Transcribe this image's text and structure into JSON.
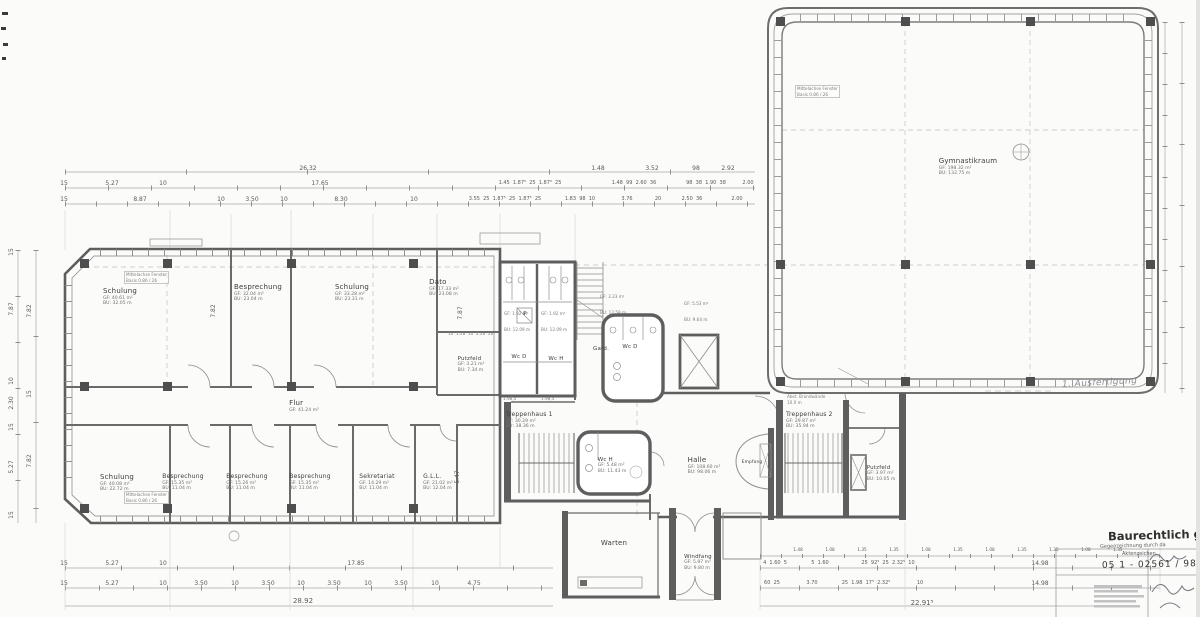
{
  "plan": {
    "rooms": {
      "schulung_tl": {
        "name": "Schulung",
        "gf": "GF: 40.61 m²",
        "bu": "BU: 32.05 m"
      },
      "besprechung_t": {
        "name": "Besprechung",
        "gf": "GF: 32.04 m²",
        "bu": "BU: 23.04 m"
      },
      "schulung_tm": {
        "name": "Schulung",
        "gf": "GF: 33.28 m²",
        "bu": "BU: 23.31 m"
      },
      "dato": {
        "name": "Dato",
        "gf": "GF: 17.33 m²",
        "bu": "BU: 23.08 m"
      },
      "flur": {
        "name": "Flur",
        "gf": "GF: 41.24 m²",
        "bu": "BU: 47.34 m"
      },
      "putzfeld_l": {
        "name": "Putzfeld",
        "gf": "GF: 3.21 m²",
        "bu": "BU: 7.34 m"
      },
      "wc_d_top": {
        "name": "Wc D",
        "gf": "GF: 1.92 m²",
        "bu": "BU: 12.09 m"
      },
      "wc_h_top": {
        "name": "Wc H",
        "gf": "GF: 1.92 m²",
        "bu": "BU: 12.09 m"
      },
      "p_shaft": {
        "name": "P"
      },
      "gard": {
        "name": "Gard."
      },
      "wc_d_mid": {
        "name": "Wc D",
        "gf": "GF: 3.23 m²",
        "bu": "BU: 12.58 m"
      },
      "aufzug": {
        "gf": "GF: 5.53 m²",
        "bu": "BU: 9.64 m"
      },
      "treppenhaus_1": {
        "name": "Treppenhaus 1",
        "gf": "GF: 30.29 m²",
        "bu": "BU: 38.36 m"
      },
      "wc_h_low": {
        "name": "Wc H",
        "gf": "GF: 5.48 m²",
        "bu": "BU: 11.43 m"
      },
      "halle": {
        "name": "Halle",
        "gf": "GF: 108.60 m²",
        "bu": "BU: 98.06 m"
      },
      "empfang": {
        "name": "Empfang"
      },
      "treppenhaus_2": {
        "name": "Treppenhaus 2",
        "gf": "GF: 29.87 m²",
        "bu": "BU: 35.94 m"
      },
      "putzfeld_r": {
        "name": "Putzfeld",
        "gf": "GF: 3.97 m²",
        "bu": "BU: 10.05 m"
      },
      "warten": {
        "name": "Warten"
      },
      "windfang": {
        "name": "Windfang",
        "gf": "GF: 5.97 m²",
        "bu": "BU: 9.80 m"
      },
      "gymnastikraum": {
        "name": "Gymnastikraum",
        "gf": "GF: 198.32 m²",
        "bu": "BU: 132.75 m"
      },
      "schulung_b": {
        "name": "Schulung",
        "gf": "GF: 40.08 m²",
        "bu": "BU: 22.72 m"
      },
      "besprechung_b1": {
        "name": "Besprechung",
        "gf": "GF: 15.35 m²",
        "bu": "BU: 11.04 m"
      },
      "besprechung_b2": {
        "name": "Besprechung",
        "gf": "GF: 15.26 m²",
        "bu": "BU: 11.04 m"
      },
      "besprechung_b3": {
        "name": "Besprechung",
        "gf": "GF: 15.35 m²",
        "bu": "BU: 11.04 m"
      },
      "sekretariat": {
        "name": "Sekretariat",
        "gf": "GF: 14.29 m²",
        "bu": "BU: 11.04 m"
      },
      "gll": {
        "name": "G.L.L.",
        "gf": "GF: 21.02 m²",
        "bu": "BU: 12.04 m"
      }
    },
    "notes": {
      "fenster_tl": {
        "l1": "Mittelachse Fenster",
        "l2": "Basis 0.86 /.26"
      },
      "fenster_bl": {
        "l1": "Mittelachse Fenster",
        "l2": "Basis 0.86 /.26"
      },
      "fenster_gym": {
        "l1": "Mittelachse Fenster",
        "l2": "Basis 0.86 /.26"
      },
      "brandwand": {
        "l1": "Abst. Brandwände",
        "l2": "10.0 m"
      },
      "wc_micro": "1.98,5",
      "dato_micro": "10  1.28  10  2.26  26"
    },
    "stamp": {
      "ausfertigung": "1. Ausfertigung",
      "baurecht": "Baurechtlich ge",
      "gegenzeichnung": "Gegenzeichnung durch da",
      "aktenzeichen": "Aktenzeichen",
      "nummer": "05 1 - 02561 / 98"
    },
    "dims": {
      "ra": [
        "26.32",
        "1.48",
        "3.52",
        "98",
        "2.92"
      ],
      "rb": [
        "15",
        "5.27",
        "10",
        "17.65",
        "1.45  1.87⁵  25  1.87⁵  25",
        "1.48  99  2.60  36",
        "98  38  1.90  38",
        "2.00"
      ],
      "rc": [
        "15",
        "8.87",
        "10",
        "3.50",
        "10",
        "8.30",
        "10",
        "3.55  25  1.87⁵  25  1.87⁵  25",
        "1.83  98  10",
        "3.76",
        "20",
        "2.50  36",
        "2.00"
      ],
      "rd": [
        "15",
        "5.27",
        "10",
        "17.85"
      ],
      "rdr": [
        "4  1.60  5",
        "5  1.60",
        "25  92⁵  25  2.32⁵  10",
        "14.98"
      ],
      "re": [
        "15",
        "5.27",
        "10",
        "3.50",
        "10",
        "3.50",
        "10",
        "3.50",
        "10",
        "3.50",
        "10",
        "4.75"
      ],
      "rer": [
        "60  25",
        "3.70",
        "25  1.98  17⁵  2.32⁵",
        "10",
        "14.98"
      ],
      "rf": [
        "28.92",
        "22.91⁵"
      ],
      "micro_r": "1.48  1.08  1.35  1.35  1.08  1.35  1.08  1.35  1.35  1.08  1.35",
      "lv": [
        "15",
        "7.87",
        "10",
        "2.30",
        "15",
        "5.27",
        "15"
      ],
      "lv2": [
        "7.82",
        "15",
        "7.82"
      ],
      "iv": [
        "7.82",
        "7.87",
        "5.47"
      ]
    }
  }
}
